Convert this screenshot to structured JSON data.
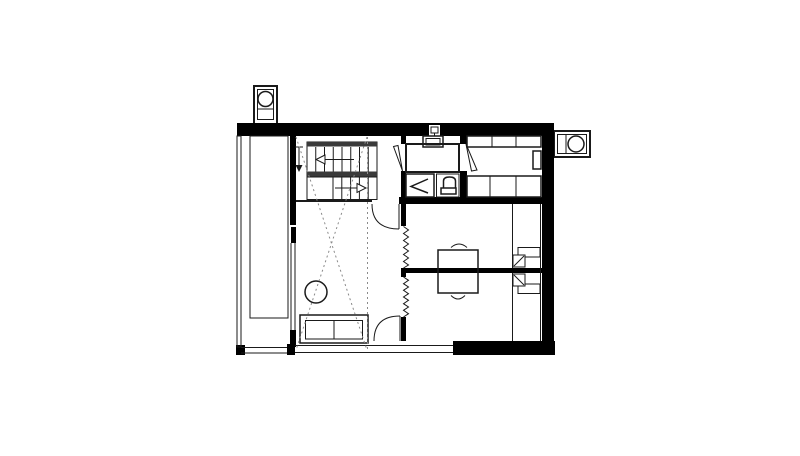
{
  "document": {
    "kind": "architectural-floor-plan",
    "text_labels": []
  },
  "colors": {
    "wall": "#000000",
    "line": "#1a1a1a",
    "muted": "#3a3a3a",
    "dotted": "#8a8a8a",
    "bg": "#ffffff"
  },
  "plan": {
    "rooms": [
      "balcony",
      "stair-hall",
      "living-room",
      "bathroom",
      "kitchen",
      "bedroom-1",
      "bedroom-2"
    ],
    "fixtures": [
      "staircase",
      "washbasin",
      "bathtub",
      "shower",
      "toilet",
      "kitchen-counters",
      "flue-box",
      "sofa",
      "round-table",
      "shared-desk",
      "desk-chairs",
      "wardrobe-steps",
      "chimney-top-left",
      "chimney-right"
    ],
    "annotations": [
      "void-dashed-cross",
      "void-dashed-edge",
      "stair-direction-arrows",
      "entry-arrow",
      "folding-door-zigzags",
      "door-swing-arcs"
    ]
  }
}
